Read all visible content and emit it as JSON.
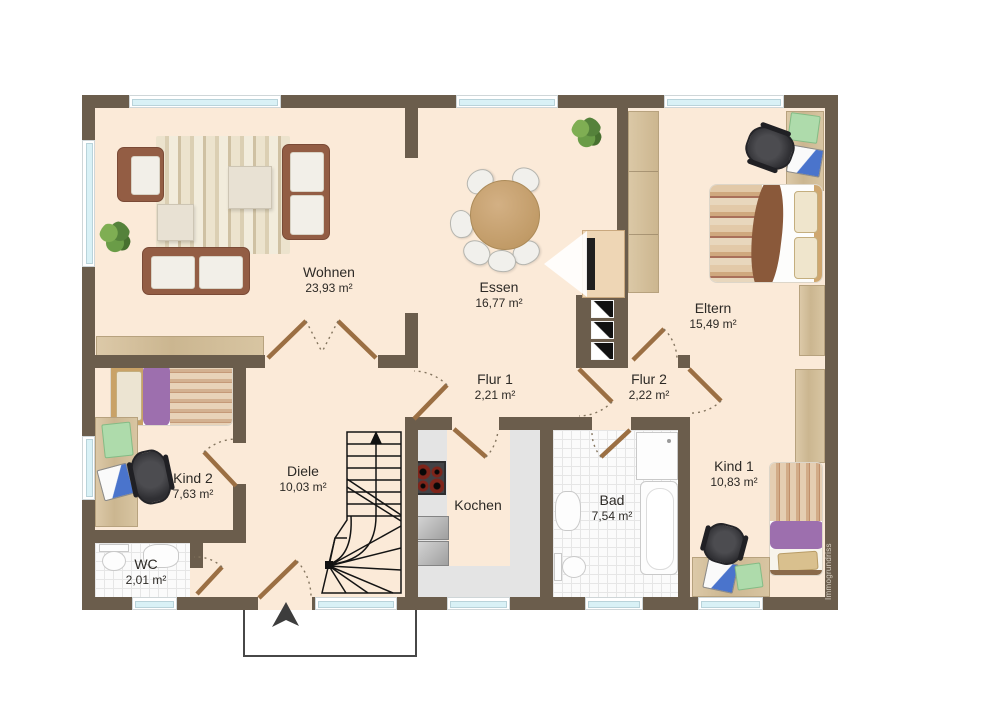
{
  "watermark": "Immogrundriss",
  "rooms": {
    "wohnen": {
      "name": "Wohnen",
      "area": "23,93 m²"
    },
    "essen": {
      "name": "Essen",
      "area": "16,77 m²"
    },
    "eltern": {
      "name": "Eltern",
      "area": "15,49 m²"
    },
    "flur1": {
      "name": "Flur 1",
      "area": "2,21 m²"
    },
    "flur2": {
      "name": "Flur 2",
      "area": "2,22 m²"
    },
    "kind1": {
      "name": "Kind 1",
      "area": "10,83 m²"
    },
    "kind2": {
      "name": "Kind 2",
      "area": "7,63 m²"
    },
    "diele": {
      "name": "Diele",
      "area": "10,03 m²"
    },
    "kochen": {
      "name": "Kochen"
    },
    "bad": {
      "name": "Bad",
      "area": "7,54 m²"
    },
    "wc": {
      "name": "WC",
      "area": "2,01 m²"
    }
  },
  "colors": {
    "wall": "#6b5d4c",
    "floor": "#fbead8",
    "window_glass": "#d9f1f6",
    "door_leaf": "#9b6f43",
    "wood_furniture": "#d5c2a0",
    "bed_purple": "#9d6fae",
    "kitchen_counter": "#e4e4e4",
    "stair_lines": "#111111"
  }
}
